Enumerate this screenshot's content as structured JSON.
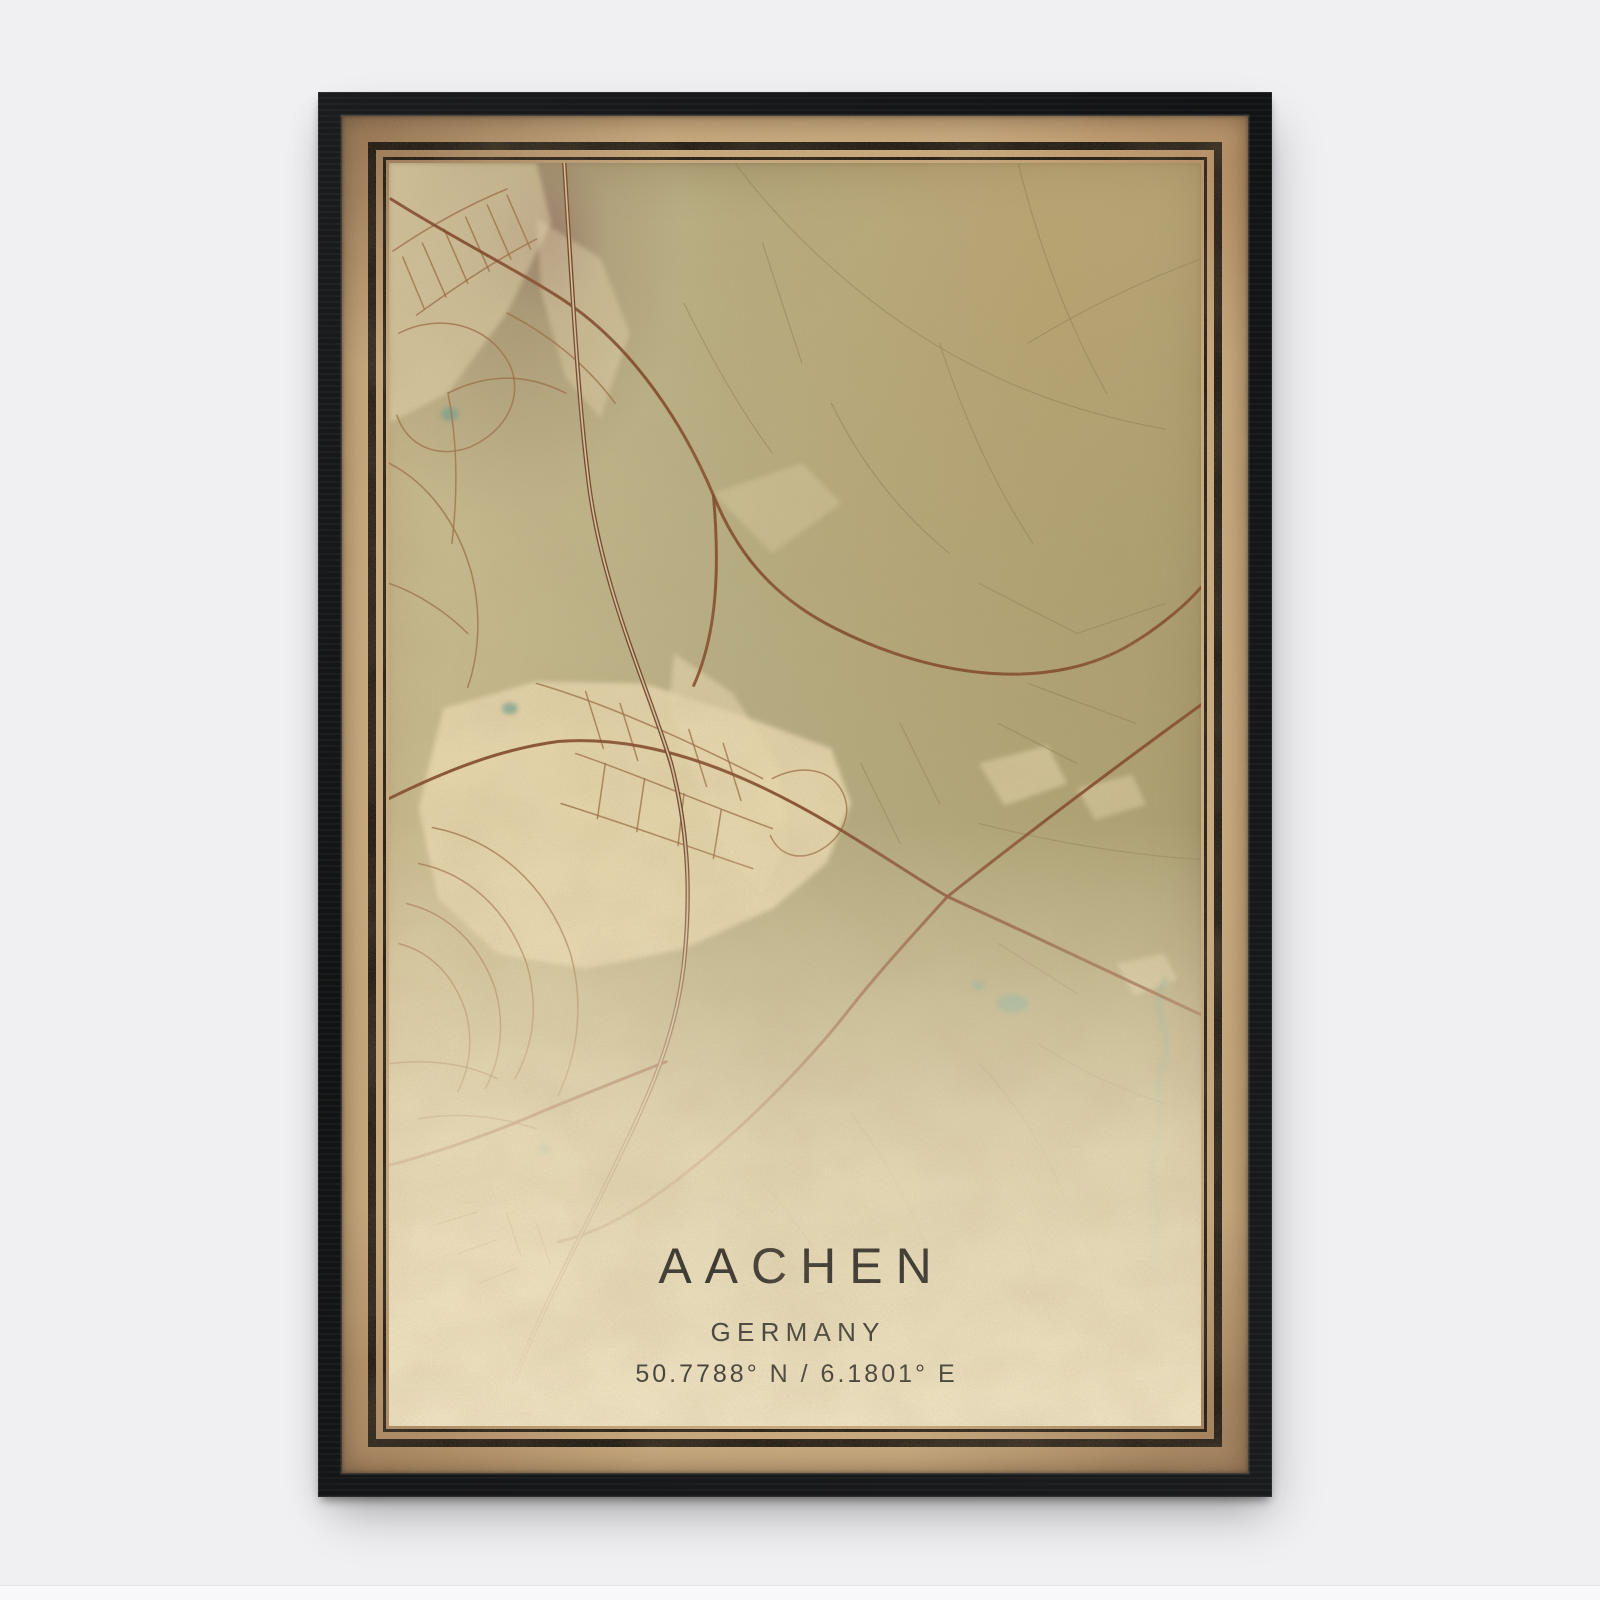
{
  "poster": {
    "title": "AACHEN",
    "subtitle": "GERMANY",
    "coordinates": "50.7788° N / 6.1801° E"
  },
  "colors": {
    "wall": "#f0f0f2",
    "floor": "#f8f8fa",
    "frame": "#141517",
    "paper": "#c9a87c",
    "rule": "#1a140d",
    "map_base": "#b4ab7f",
    "map_cream": "#ecdcb2",
    "road_major": "#7d4023",
    "road_minor": "#96683f",
    "road_faint": "#8d7c52",
    "rail": "#6e3b22",
    "water": "#6fa090",
    "ink": "#2f2d29"
  }
}
